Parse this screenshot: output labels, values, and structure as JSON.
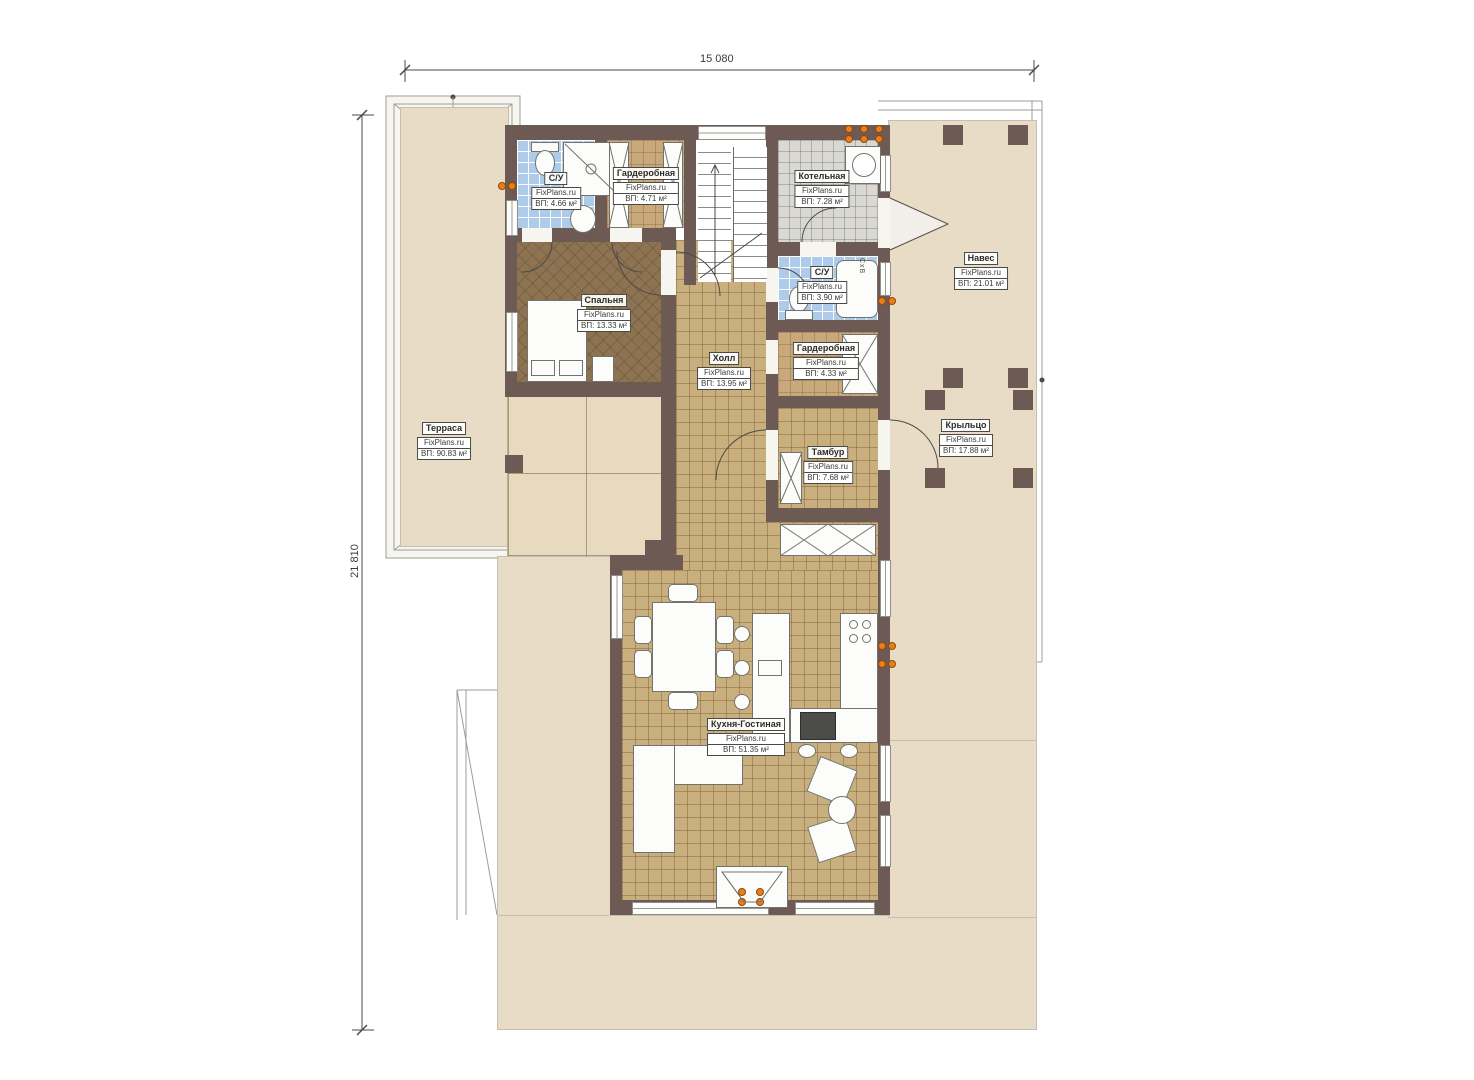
{
  "brand": "FixPlans.ru",
  "dimensions": {
    "width": "15 080",
    "height": "21 810"
  },
  "annotations": {
    "shaft": "СxВ"
  },
  "rooms": [
    {
      "name": "С/У",
      "brand": "FixPlans.ru",
      "area": "ВП: 4.66 м²"
    },
    {
      "name": "Гардеробная",
      "brand": "FixPlans.ru",
      "area": "ВП: 4.71 м²"
    },
    {
      "name": "Котельная",
      "brand": "FixPlans.ru",
      "area": "ВП: 7.28 м²"
    },
    {
      "name": "Навес",
      "brand": "FixPlans.ru",
      "area": "ВП: 21.01 м²"
    },
    {
      "name": "Спальня",
      "brand": "FixPlans.ru",
      "area": "ВП: 13.33 м²"
    },
    {
      "name": "С/У",
      "brand": "FixPlans.ru",
      "area": "ВП: 3.90 м²"
    },
    {
      "name": "Гардеробная",
      "brand": "FixPlans.ru",
      "area": "ВП: 4.33 м²"
    },
    {
      "name": "Холл",
      "brand": "FixPlans.ru",
      "area": "ВП: 13.95 м²"
    },
    {
      "name": "Тамбур",
      "brand": "FixPlans.ru",
      "area": "ВП: 7.68 м²"
    },
    {
      "name": "Крыльцо",
      "brand": "FixPlans.ru",
      "area": "ВП: 17.88 м²"
    },
    {
      "name": "Терраса",
      "brand": "FixPlans.ru",
      "area": "ВП: 90.83 м²"
    },
    {
      "name": "Кухня-Гостиная",
      "brand": "FixPlans.ru",
      "area": "ВП: 51.35 м²"
    }
  ],
  "colors": {
    "wall": "#6e5a54",
    "tile": "#c9ae7e",
    "wet_tile": "#aecbe9",
    "outdoor": "#e9dcc6",
    "vent_marker": "#ec7d1d"
  }
}
